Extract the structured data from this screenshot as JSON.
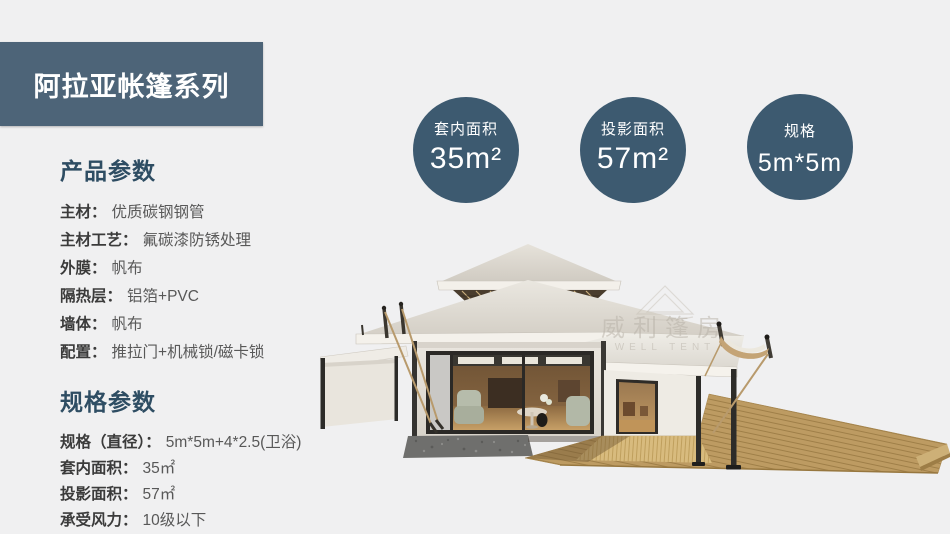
{
  "banner": {
    "title": "阿拉亚帐篷系列"
  },
  "colors": {
    "banner_bg": "#4d6478",
    "heading": "#2e4d63",
    "badge_bg": "#3d5a70",
    "page_bg": "#f0f0f1"
  },
  "product_params": {
    "heading": "产品参数",
    "items": [
      {
        "label": "主材：",
        "value": "优质碳钢钢管"
      },
      {
        "label": "主材工艺：",
        "value": "氟碳漆防锈处理"
      },
      {
        "label": "外膜：",
        "value": "帆布"
      },
      {
        "label": "隔热层：",
        "value": "铝箔+PVC"
      },
      {
        "label": "墙体：",
        "value": "帆布"
      },
      {
        "label": "配置：",
        "value": "推拉门+机械锁/磁卡锁"
      }
    ]
  },
  "spec_params": {
    "heading": "规格参数",
    "items": [
      {
        "label": "规格（直径）：",
        "value": "5m*5m+4*2.5(卫浴)"
      },
      {
        "label": "套内面积：",
        "value": "35㎡"
      },
      {
        "label": "投影面积：",
        "value": "57㎡"
      },
      {
        "label": "承受风力：",
        "value": "10级以下"
      }
    ]
  },
  "badges": [
    {
      "label": "套内面积",
      "value": "35m²"
    },
    {
      "label": "投影面积",
      "value": "57m²"
    },
    {
      "label": "规格",
      "value": "5m*5m"
    }
  ],
  "watermark": {
    "line1": "威利篷房",
    "line2": "WELL TENT"
  }
}
